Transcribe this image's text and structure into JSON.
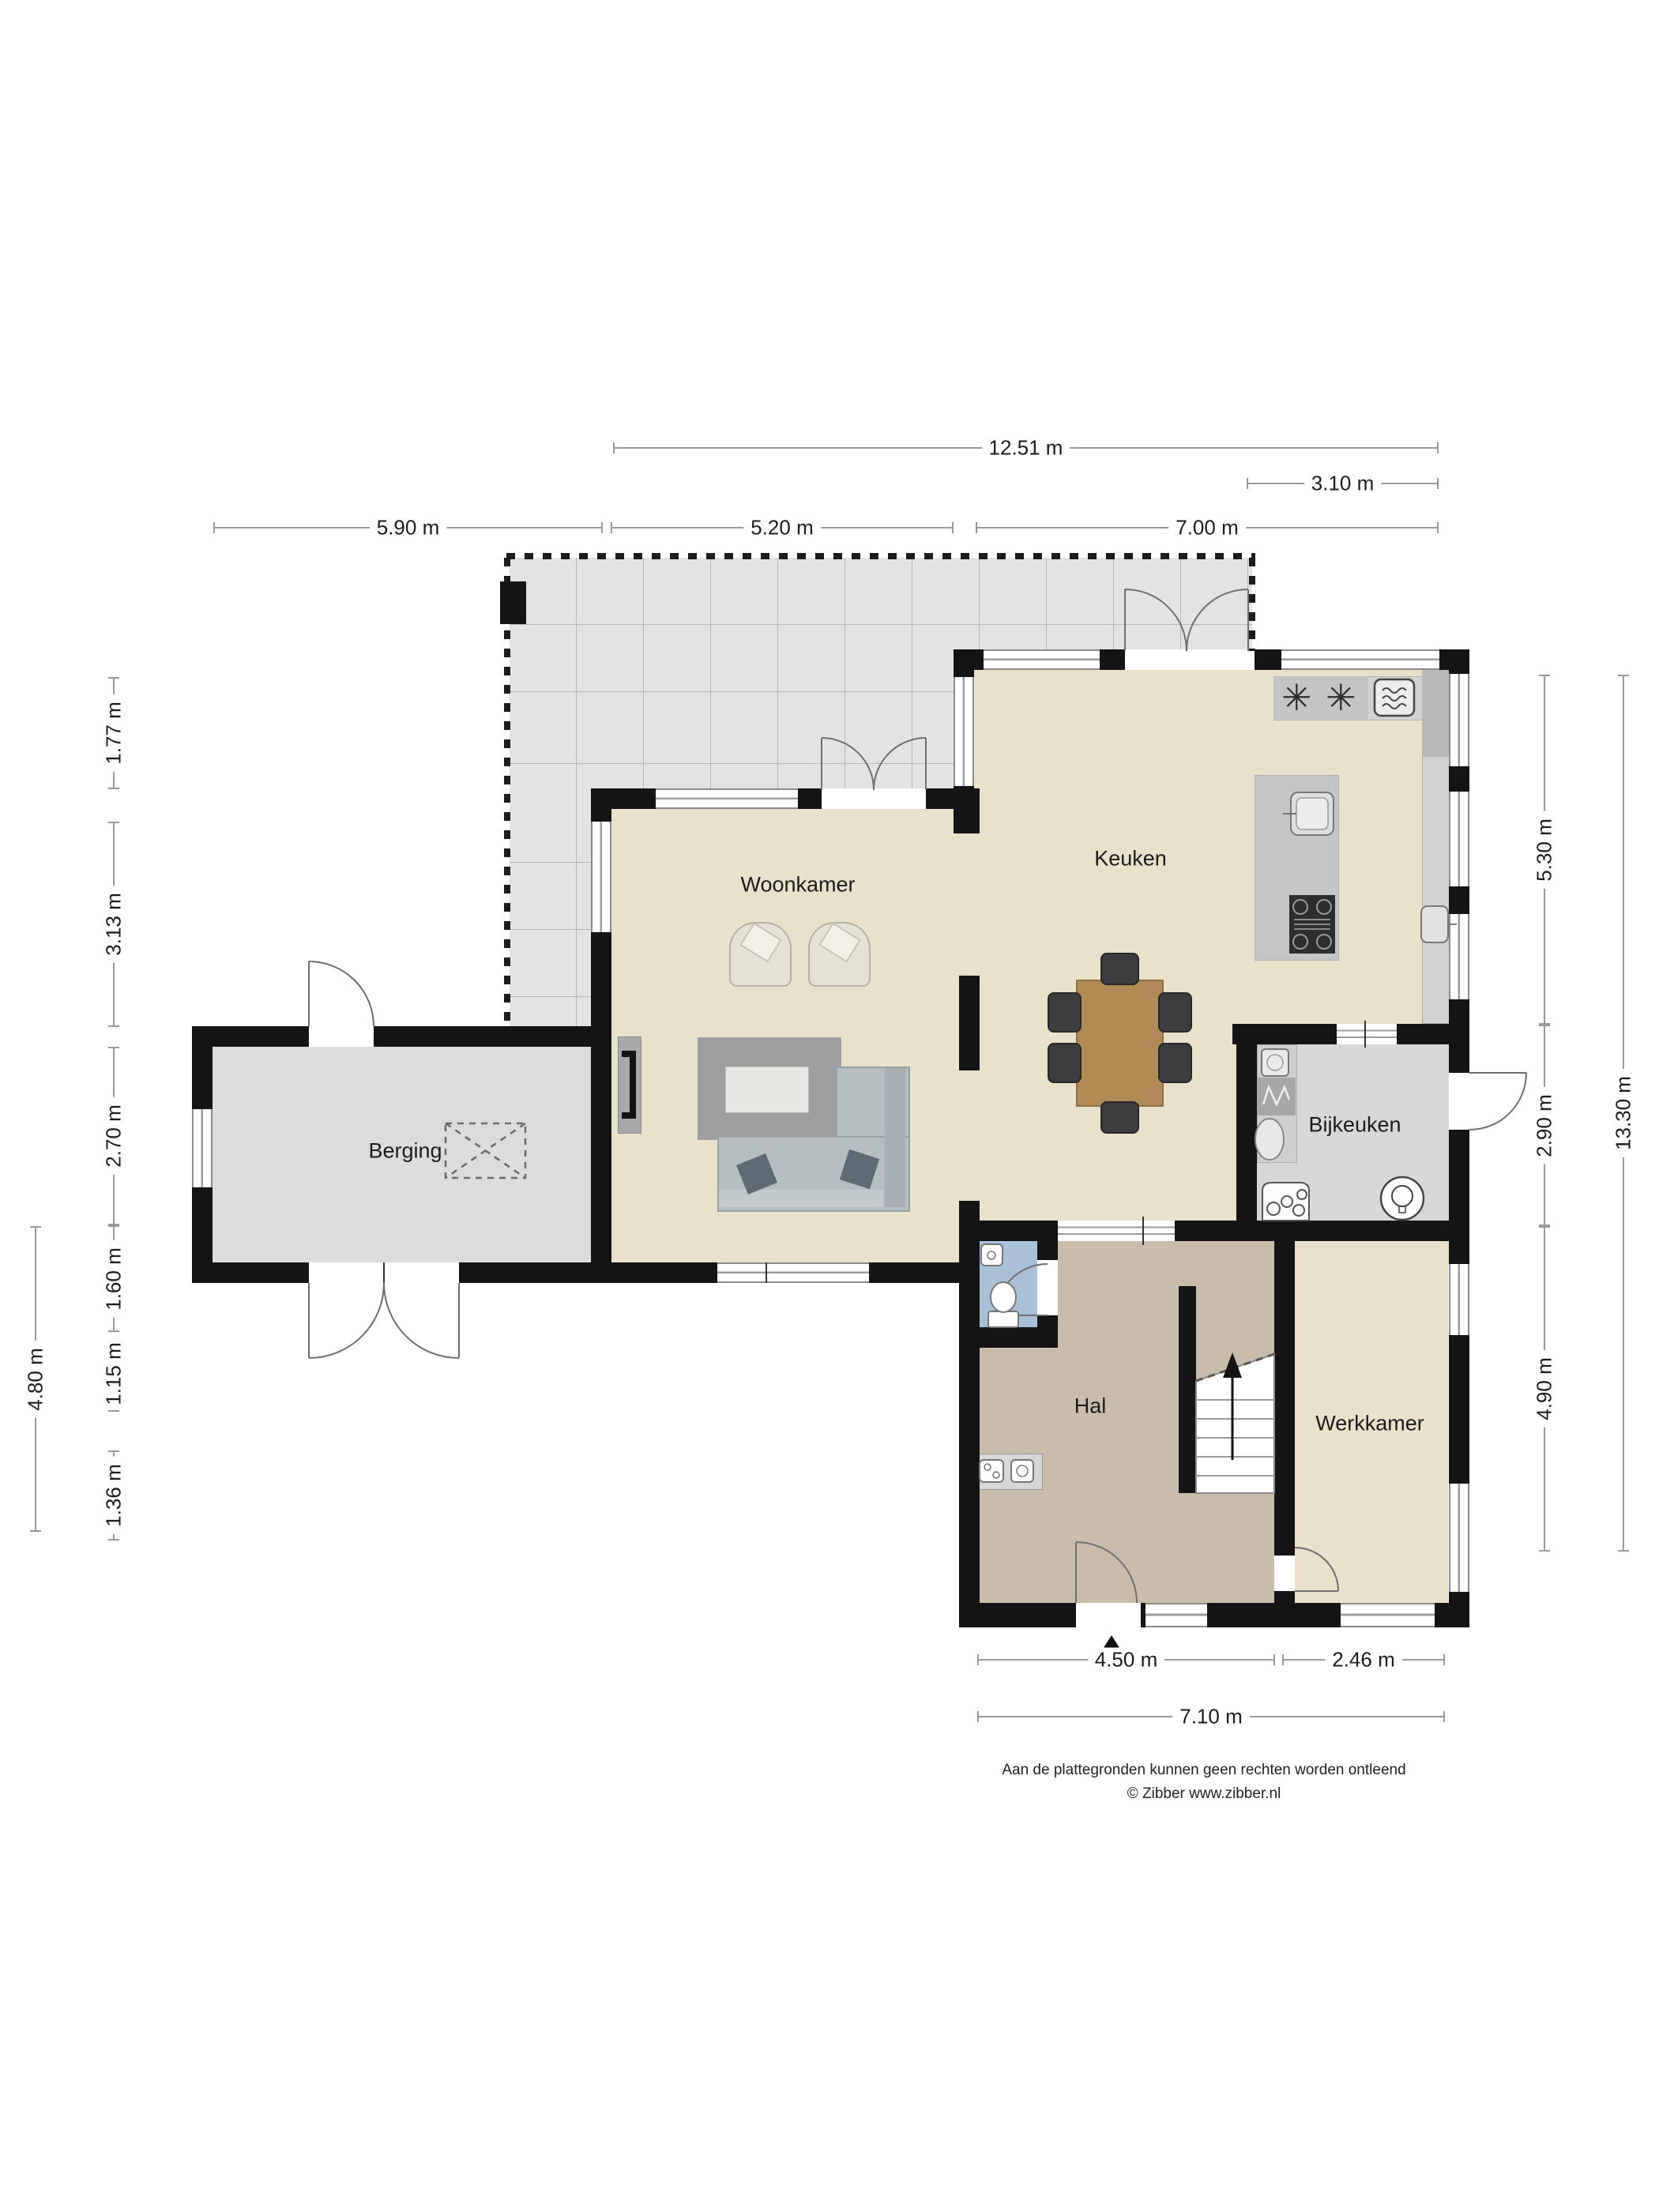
{
  "rooms": {
    "woonkamer": "Woonkamer",
    "keuken": "Keuken",
    "berging": "Berging",
    "bijkeuken": "Bijkeuken",
    "hal": "Hal",
    "werkkamer": "Werkkamer"
  },
  "dims": {
    "t_total": "12.51 m",
    "t_right": "3.10 m",
    "t_seg1": "5.90 m",
    "t_seg2": "5.20 m",
    "t_seg3": "7.00 m",
    "l_outer": "4.80 m",
    "l_seg1": "1.77 m",
    "l_seg2": "3.13 m",
    "l_seg3": "2.70 m",
    "l_seg4": "1.60 m",
    "l_seg5": "1.15 m",
    "l_seg6": "1.36 m",
    "r_seg1": "5.30 m",
    "r_seg2": "2.90 m",
    "r_seg3": "4.90 m",
    "r_outer": "13.30 m",
    "b_seg1": "4.50 m",
    "b_seg2": "2.46 m",
    "b_outer": "7.10 m"
  },
  "footer": {
    "line1": "Aan de plattegronden kunnen geen rechten worden ontleend",
    "line2": "© Zibber www.zibber.nl"
  },
  "icons": {
    "gas_burner": "✳"
  },
  "colors": {
    "wall": "#141414",
    "floor_living": "#e9e1c9",
    "floor_hal": "#c9bcaa",
    "floor_storage": "#dcdcdc",
    "floor_utility": "#d8d8d8",
    "floor_toilet": "#a9c0d9",
    "terrace_tile": "#e3e3e3",
    "table_wood": "#b28a55",
    "dimension_line": "#9a9a9a"
  }
}
